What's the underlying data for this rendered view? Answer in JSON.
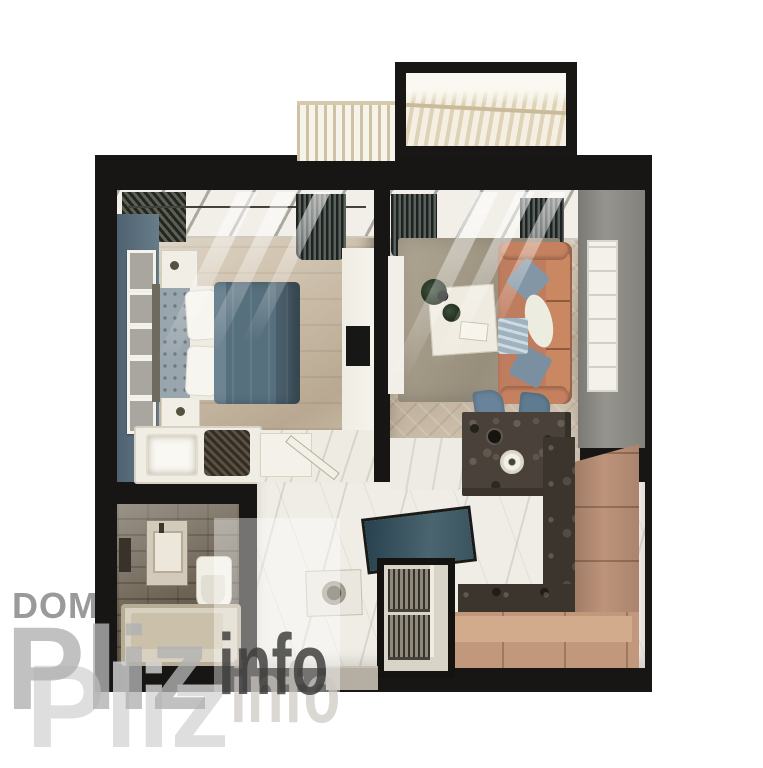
{
  "watermark": {
    "brand_top": "DOM",
    "brand_main": "Pliz",
    "brand_suffix": "info"
  },
  "palette": {
    "wall_black": "#181614",
    "bedroom_accent_wall": "#5d7280",
    "bed_duvet_blue": "#57707e",
    "sofa_terracotta": "#bf7d60",
    "pillow_blue": "#8296a5",
    "kitchen_cabinet_tan": "#c1987b",
    "countertop_granite": "#3b352e",
    "island_teal": "#3a5560",
    "balcony_wood": "#ded2b7",
    "floor_wood": "#cdbfa9",
    "floor_marble": "#f0ede6",
    "right_wall_gray": "#8b8984",
    "bathroom_tile": "#6e6455",
    "watermark_light_gray": "#b2b2b2",
    "watermark_dark_gray": "#3b3b39"
  }
}
